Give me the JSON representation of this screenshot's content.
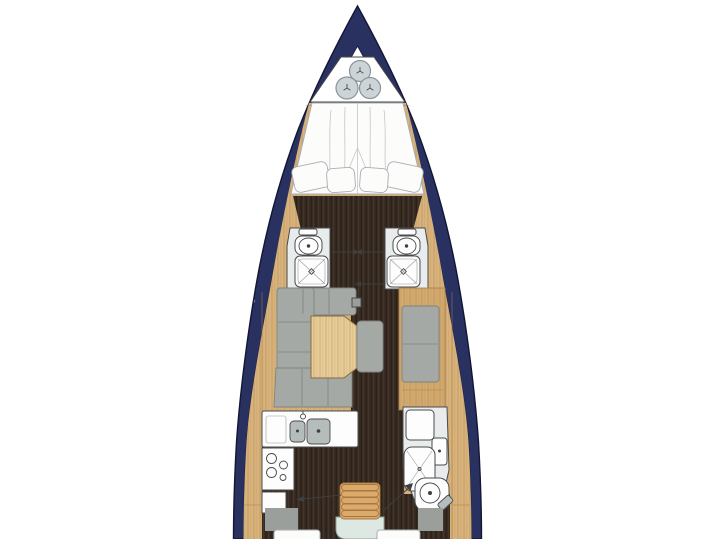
{
  "meta": {
    "title": "Sailing yacht interior layout plan (top view)",
    "type": "boat floor plan",
    "visible_text": ""
  },
  "colors": {
    "background": "#ffffff",
    "hull": "#28315f",
    "hull_outline": "#131735",
    "hull_inner_line": "#1c2142",
    "interior_white": "#ffffff",
    "wood": "#d9b37c",
    "wood_cabinet": "#d3aa6f",
    "wood_line": "#a97f47",
    "wood_table": "#e7cc97",
    "table_line": "#8a6a3e",
    "floor_dark": "#382b21",
    "cushion": "#a4a9a5",
    "cushion_seam": "#7e847e",
    "bath_floor": "#e8eced",
    "fixture_white": "#fdfdfd",
    "fixture_line": "#4a4a4a",
    "sink_gray": "#b5bdbc",
    "fender": "#cdd4d8",
    "fender_line": "#8a949b",
    "bed_white": "#fcfcfb",
    "bed_line": "#a9aeb2",
    "bed_fold": "#c2c7cb",
    "steps": "#dca96c",
    "steps_line": "#a6793f",
    "engine_box": "#dde8e2",
    "engine_line": "#8fa69b",
    "door_line": "#3f3f3f",
    "gray_block": "#9b9f9b"
  },
  "areas": {
    "anchor_locker": "bow anchor locker with three fenders",
    "forward_cabin": "forward V-berth double cabin",
    "port_head": "port bathroom: toilet and shower",
    "starboard_head": "starboard bathroom: toilet and shower",
    "salon": "salon: U-shaped settee, table, starboard bench",
    "galley": "port galley: double sink, stove, cabinets",
    "aft_head": "starboard aft bathroom: shower, sink, toilet",
    "companionway": "companionway steps over engine box",
    "aft_cabins": "aft cabins partially visible at image edge"
  }
}
